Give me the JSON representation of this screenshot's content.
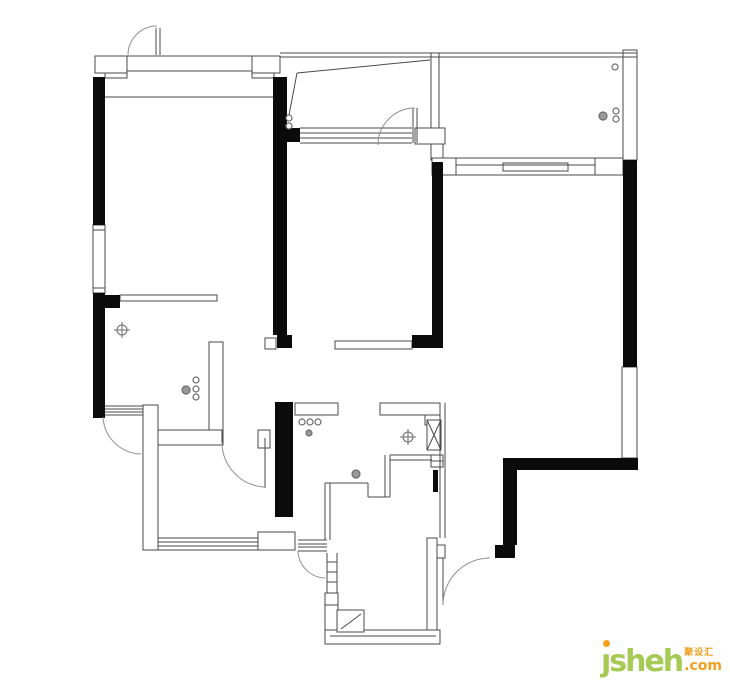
{
  "watermark": {
    "brand_head": "ȷ",
    "brand_rest": "sheh",
    "cjk": "聚设汇",
    "com": ".com",
    "green": "#a6ca55",
    "orange": "#f59e1b"
  },
  "plan": {
    "width": 730,
    "height": 681,
    "background": "#ffffff",
    "wall_color": "#0b0b0b",
    "line_color": "#4a4a4a",
    "door_color": "#8f8f8f",
    "symbol_color": "#6a6a6a",
    "black_walls": [
      [
        93,
        77,
        12,
        148
      ],
      [
        93,
        293,
        12,
        125
      ],
      [
        105,
        295,
        15,
        13
      ],
      [
        273,
        77,
        14,
        258
      ],
      [
        277,
        335,
        15,
        13
      ],
      [
        287,
        128,
        13,
        14
      ],
      [
        432,
        162,
        11,
        173
      ],
      [
        412,
        335,
        31,
        13
      ],
      [
        623,
        160,
        14,
        207
      ],
      [
        503,
        458,
        135,
        12
      ],
      [
        503,
        470,
        14,
        75
      ],
      [
        495,
        545,
        20,
        13
      ],
      [
        275,
        402,
        18,
        115
      ],
      [
        433,
        470,
        5,
        22
      ]
    ],
    "white_walls": [
      [
        95,
        56,
        32,
        17
      ],
      [
        105,
        73,
        22,
        5
      ],
      [
        252,
        56,
        28,
        17
      ],
      [
        252,
        73,
        22,
        5
      ],
      [
        415,
        128,
        30,
        16
      ],
      [
        431,
        144,
        12,
        16
      ],
      [
        623,
        50,
        14,
        110
      ],
      [
        432,
        158,
        24,
        17
      ],
      [
        595,
        158,
        28,
        17
      ],
      [
        503,
        163,
        65,
        8
      ],
      [
        622,
        367,
        15,
        91
      ],
      [
        93,
        225,
        12,
        68
      ],
      [
        120,
        295,
        97,
        6
      ],
      [
        335,
        341,
        77,
        8
      ],
      [
        209,
        342,
        14,
        103
      ],
      [
        158,
        430,
        64,
        15
      ],
      [
        143,
        405,
        15,
        145
      ],
      [
        258,
        430,
        12,
        18
      ],
      [
        265,
        338,
        11,
        11
      ],
      [
        258,
        532,
        37,
        18
      ],
      [
        295,
        403,
        43,
        12
      ],
      [
        380,
        403,
        60,
        12
      ],
      [
        425,
        415,
        15,
        10
      ],
      [
        325,
        593,
        13,
        12
      ],
      [
        325,
        605,
        13,
        25
      ],
      [
        325,
        630,
        115,
        14
      ],
      [
        427,
        538,
        10,
        92
      ],
      [
        437,
        545,
        8,
        13
      ],
      [
        427,
        420,
        14,
        30
      ],
      [
        431,
        455,
        12,
        12
      ],
      [
        337,
        610,
        27,
        22
      ]
    ],
    "lines": [
      [
        95,
        56,
        280,
        56
      ],
      [
        127,
        71,
        252,
        71
      ],
      [
        280,
        53,
        637,
        53
      ],
      [
        280,
        57,
        637,
        57
      ],
      [
        431,
        53,
        431,
        128
      ],
      [
        439,
        53,
        439,
        128
      ],
      [
        105,
        97,
        273,
        97
      ],
      [
        300,
        128,
        412,
        128
      ],
      [
        300,
        133,
        412,
        133
      ],
      [
        300,
        138,
        412,
        138
      ],
      [
        300,
        143,
        412,
        143
      ],
      [
        456,
        158,
        595,
        158
      ],
      [
        456,
        165,
        595,
        165
      ],
      [
        456,
        175,
        595,
        175
      ],
      [
        440,
        403,
        440,
        538
      ],
      [
        445,
        403,
        445,
        538
      ],
      [
        325,
        483,
        368,
        483
      ],
      [
        368,
        483,
        368,
        497
      ],
      [
        368,
        497,
        390,
        497
      ],
      [
        385,
        455,
        385,
        497
      ],
      [
        390,
        455,
        390,
        497
      ],
      [
        390,
        455,
        432,
        455
      ],
      [
        390,
        460,
        432,
        460
      ],
      [
        325,
        483,
        325,
        540
      ],
      [
        330,
        483,
        330,
        540
      ],
      [
        158,
        538,
        258,
        538
      ],
      [
        158,
        542,
        258,
        542
      ],
      [
        158,
        546,
        258,
        546
      ],
      [
        158,
        550,
        258,
        550
      ],
      [
        103,
        406,
        143,
        406
      ],
      [
        103,
        409,
        143,
        409
      ],
      [
        103,
        412,
        143,
        412
      ],
      [
        103,
        415,
        143,
        415
      ],
      [
        298,
        540,
        327,
        540
      ],
      [
        298,
        544,
        327,
        544
      ],
      [
        298,
        547,
        327,
        547
      ],
      [
        298,
        551,
        327,
        551
      ],
      [
        327,
        553,
        327,
        593
      ],
      [
        337,
        553,
        337,
        593
      ],
      [
        327,
        562,
        337,
        562
      ],
      [
        327,
        572,
        337,
        572
      ],
      [
        327,
        582,
        337,
        582
      ],
      [
        330,
        636,
        436,
        636
      ],
      [
        93,
        230,
        105,
        230
      ],
      [
        93,
        288,
        105,
        288
      ],
      [
        341,
        629,
        361,
        614
      ],
      [
        427,
        420,
        441,
        450
      ],
      [
        441,
        420,
        427,
        450
      ],
      [
        431,
        461,
        443,
        461
      ],
      [
        430,
        60,
        297,
        73
      ],
      [
        297,
        73,
        289,
        115
      ],
      [
        156,
        28,
        156,
        55
      ],
      [
        160,
        28,
        160,
        55
      ],
      [
        413,
        108,
        413,
        143
      ],
      [
        417,
        108,
        417,
        143
      ],
      [
        265,
        438,
        265,
        488
      ],
      [
        443,
        558,
        443,
        605
      ]
    ],
    "door_arcs": [
      "M 128 55 A 29 29 0 0 1 157 26",
      "M 378 145 A 37 37 0 0 1 415 108",
      "M 103 417 A 39 39 0 0 0 141 454",
      "M 222 442 A 45 45 0 0 0 264 487",
      "M 298 551 A 28 28 0 0 0 325 578",
      "M 443 605 A 47 47 0 0 1 490 558"
    ],
    "circles": [
      [
        289,
        118,
        3,
        0
      ],
      [
        289,
        126,
        3,
        0
      ],
      [
        615,
        67,
        3,
        0
      ],
      [
        603,
        116,
        4,
        1
      ],
      [
        616,
        111,
        3,
        0
      ],
      [
        616,
        119,
        3,
        0
      ],
      [
        186,
        390,
        4,
        1
      ],
      [
        196,
        380,
        3,
        0
      ],
      [
        196,
        389,
        3,
        0
      ],
      [
        196,
        397,
        3,
        0
      ],
      [
        302,
        422,
        3,
        0
      ],
      [
        310,
        422,
        3,
        0
      ],
      [
        318,
        422,
        3,
        0
      ],
      [
        309,
        433,
        3,
        1
      ],
      [
        356,
        474,
        4,
        1
      ]
    ],
    "crosshairs": [
      [
        122,
        330
      ],
      [
        408,
        437
      ]
    ]
  }
}
